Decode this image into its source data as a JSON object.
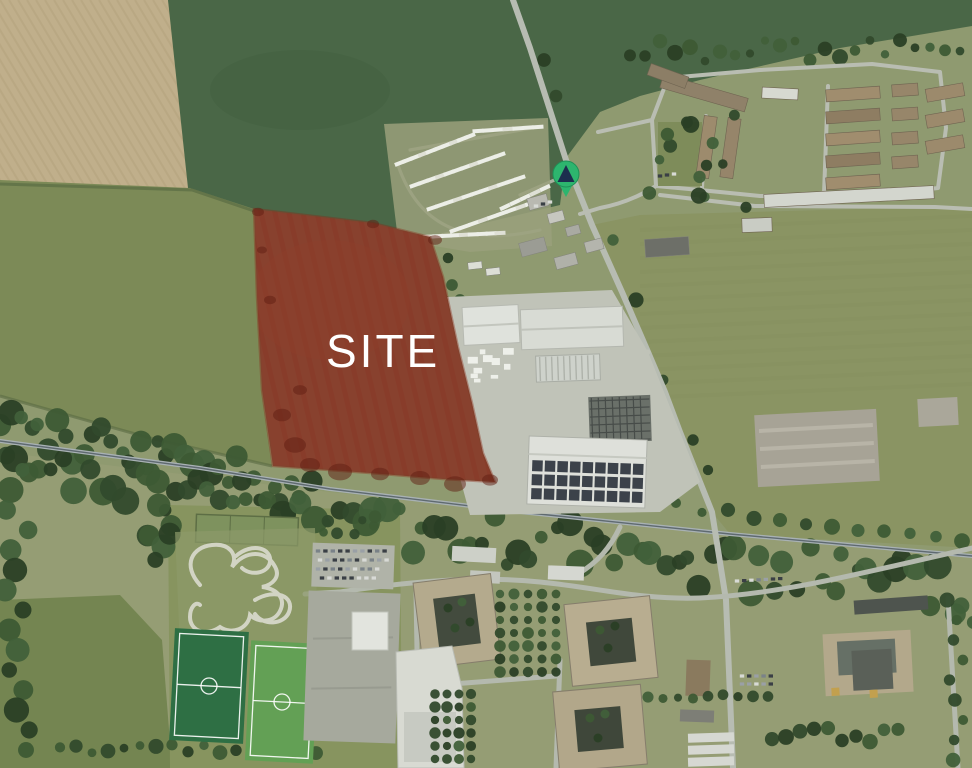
{
  "map": {
    "kind": "aerial-photograph-site-plan",
    "site_label": "SITE",
    "marker_icon": "location-marker-icon",
    "colors": {
      "site_fill": "#99251a",
      "site_soil": "#7a5a40",
      "site_border": "#8c2a1a",
      "site_dark_patch": "#5f1d12",
      "marker_green": "#2db56e",
      "marker_glyph": "#1c2f4e",
      "label_text": "#ffffff",
      "road": "#b7bcb2",
      "tree_dark": "#324a2c",
      "field_tan": "#c0af8b",
      "field_dark_green": "#4a6747",
      "field_olive": "#7c8a57",
      "pitch_dark": "#2e6f44",
      "pitch_light": "#63a055",
      "warehouse_white": "#dfe2dc",
      "solar_panel": "#3c424a"
    },
    "features": [
      "ploughed-field",
      "grass-fields",
      "caravan-park",
      "residential-estate",
      "industrial-estate",
      "tree-belt",
      "main-road",
      "bmx-track",
      "football-pitches",
      "campus-quadrangle-buildings",
      "car-parks",
      "site-boundary-overlay",
      "location-marker"
    ]
  }
}
